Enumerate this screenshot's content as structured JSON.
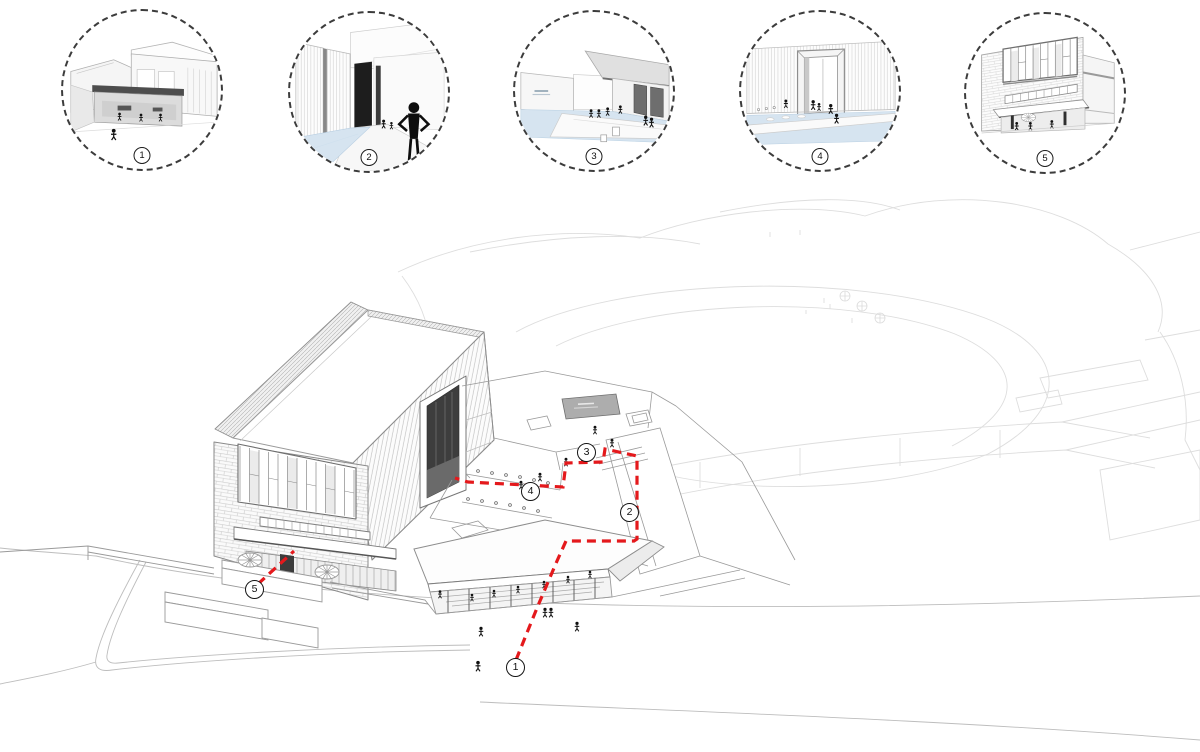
{
  "palette": {
    "route_red": "#e4191c",
    "water_blue": "#d6e4f0",
    "sign_gray": "#adadad",
    "line_gray": "#9a9a9a",
    "faded_line": "#cccccc"
  },
  "vignettes": [
    {
      "number": "1",
      "scene": "entrance-canopy-view"
    },
    {
      "number": "2",
      "scene": "water-corridor-view"
    },
    {
      "number": "3",
      "scene": "sunken-plaza-water-view"
    },
    {
      "number": "4",
      "scene": "portal-gate-view"
    },
    {
      "number": "5",
      "scene": "brick-facade-terrace-view"
    }
  ],
  "route_markers": [
    {
      "number": "1"
    },
    {
      "number": "2"
    },
    {
      "number": "3"
    },
    {
      "number": "4"
    },
    {
      "number": "5"
    }
  ]
}
